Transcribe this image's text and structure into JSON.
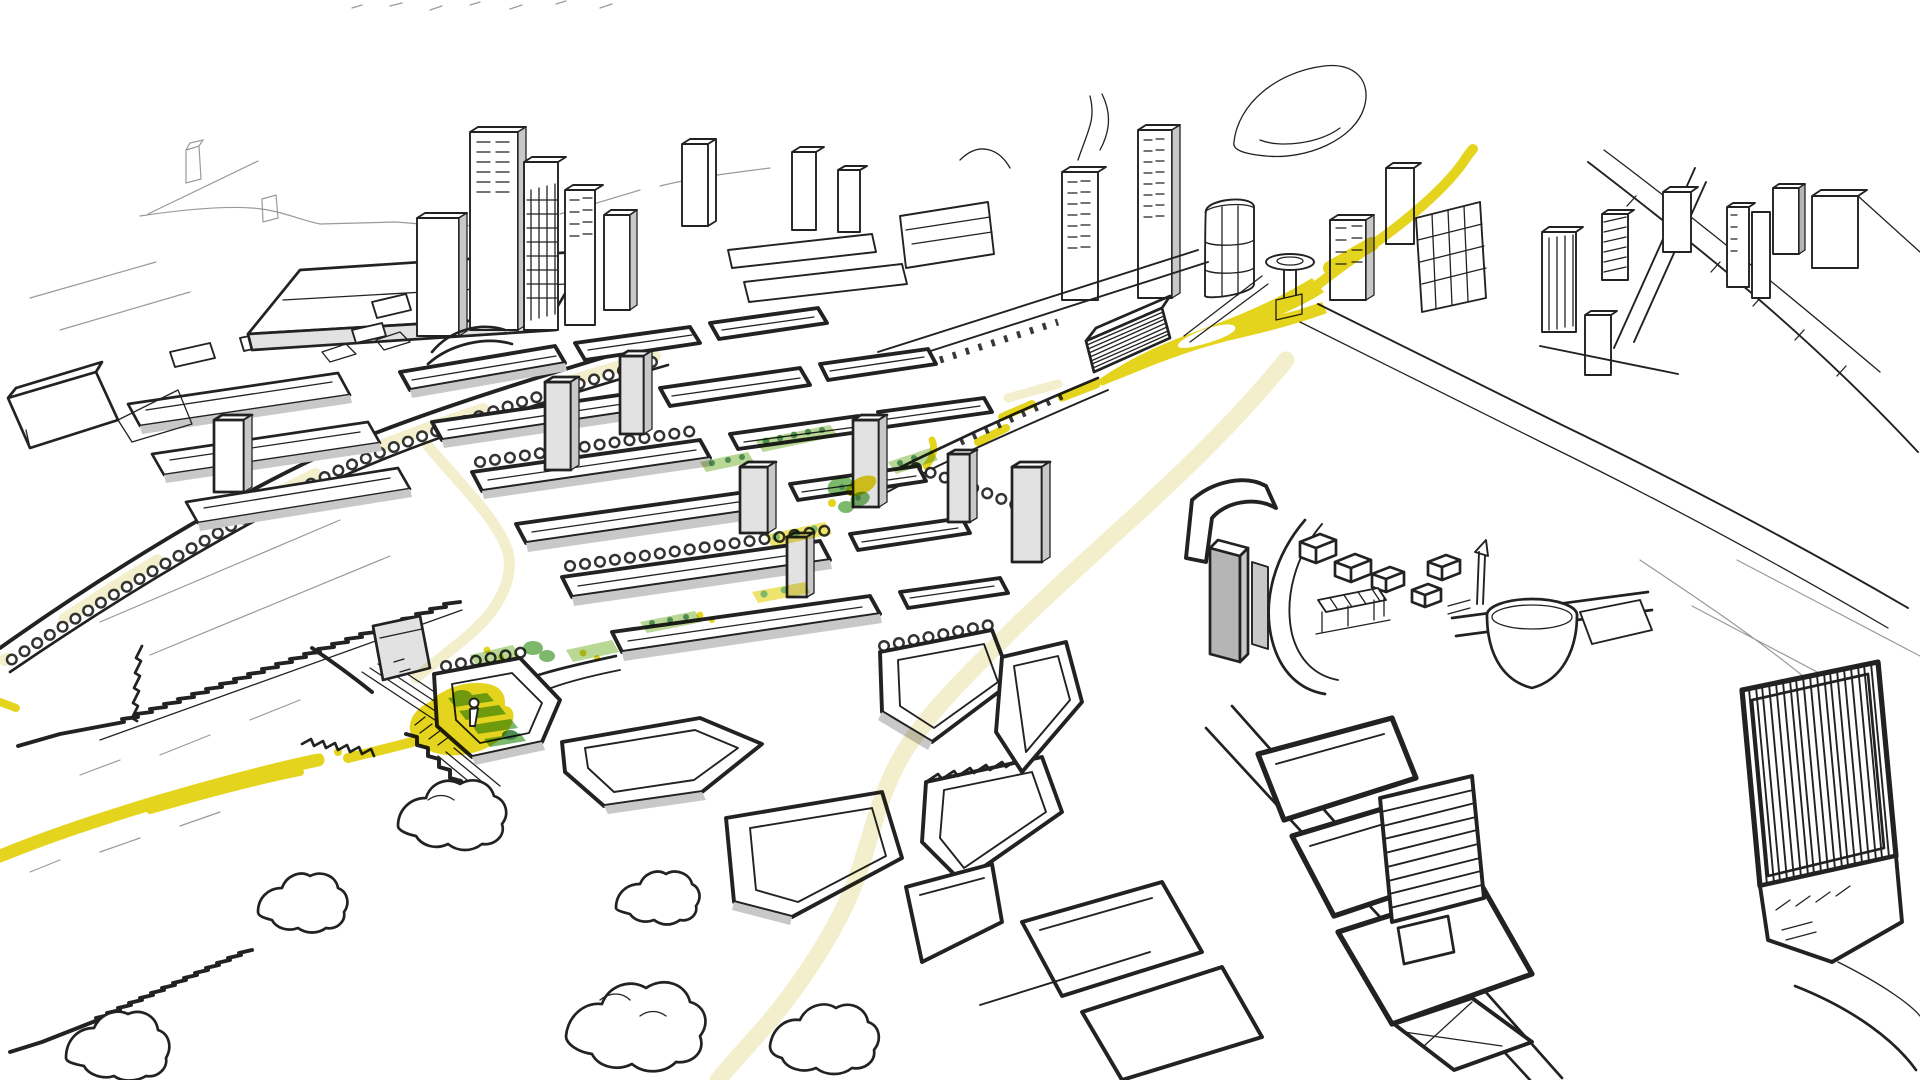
{
  "page": {
    "title": "Hand-drawn aerial masterplan sketch with highlighted yellow route"
  },
  "colors": {
    "paper": "#ffffff",
    "ink": "#222222",
    "ink_faint": "#9a9a9a",
    "building_grey": "#c8c8c8",
    "building_grey_dark": "#b5b5b5",
    "building_grey_light": "#e2e2e2",
    "route_yellow": "#e5d41e",
    "road_cream": "#f3eecb",
    "green_light": "#b9d795",
    "green_mid": "#7db96d",
    "green_dark": "#4d8d52"
  },
  "scene": {
    "type": "ink sketch, aerial perspective of a city masterplan",
    "features": [
      {
        "name": "yellow-route",
        "description": "bright yellow marker route: curve from upper right, looped junction blob with white ring, fragments along a linear park, plaza with figure, avenue exiting lower left"
      },
      {
        "name": "cream-roads",
        "description": "pale cream streets: S-curve from junction to bottom edge, western ring street, boulevard patches"
      },
      {
        "name": "green-spaces",
        "description": "green courtyard strips, tree blobs and terraced green bars along the route"
      },
      {
        "name": "central-district",
        "description": "dense diagonal grid of perimeter blocks with courtyards, grey slab towers"
      },
      {
        "name": "skyline",
        "description": "tower clusters on the horizon: left group, centre group, towers flanking the route, far-right group with crossing viaducts"
      },
      {
        "name": "warehouse",
        "description": "long flat shed with roof lights, upper left"
      },
      {
        "name": "dome",
        "description": "bowl-shaped dome landmark with mast and platform, centre right"
      },
      {
        "name": "hatched-building",
        "description": "large vertically hatched building with wing, lower right, plus striped slab and heavy-outlined blocks"
      },
      {
        "name": "fields",
        "description": "open fields with sawtooth hedgerows and tree clouds, lower left"
      },
      {
        "name": "plaza-figure",
        "description": "tiny white human figure standing on the yellow plaza"
      }
    ]
  }
}
